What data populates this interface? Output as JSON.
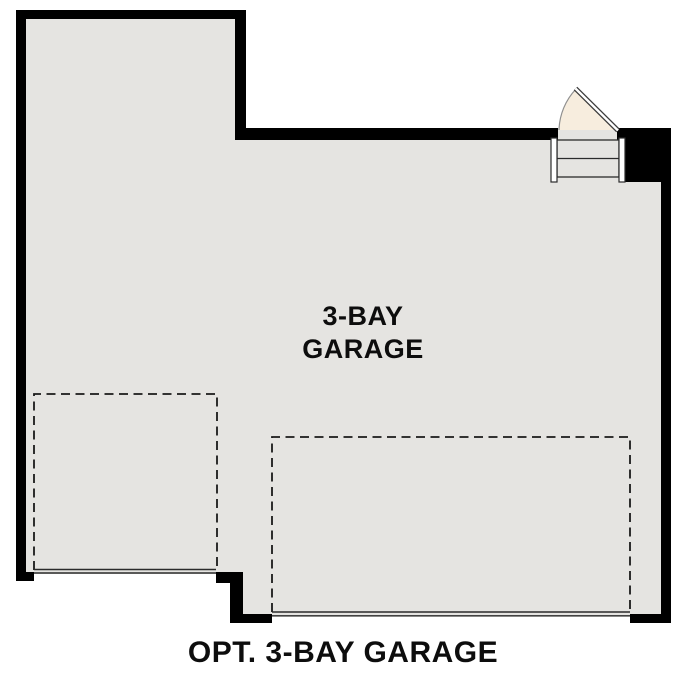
{
  "colors": {
    "wall": "#000000",
    "floor": "#e5e4e1",
    "door_swing": "#f7edde",
    "dash_line": "#1a1a1a",
    "detail_line": "#2b2b2b",
    "background": "#ffffff",
    "text": "#0d0d0d"
  },
  "labels": {
    "room_line1": "3-BAY",
    "room_line2": "GARAGE",
    "caption": "OPT. 3-BAY GARAGE"
  }
}
